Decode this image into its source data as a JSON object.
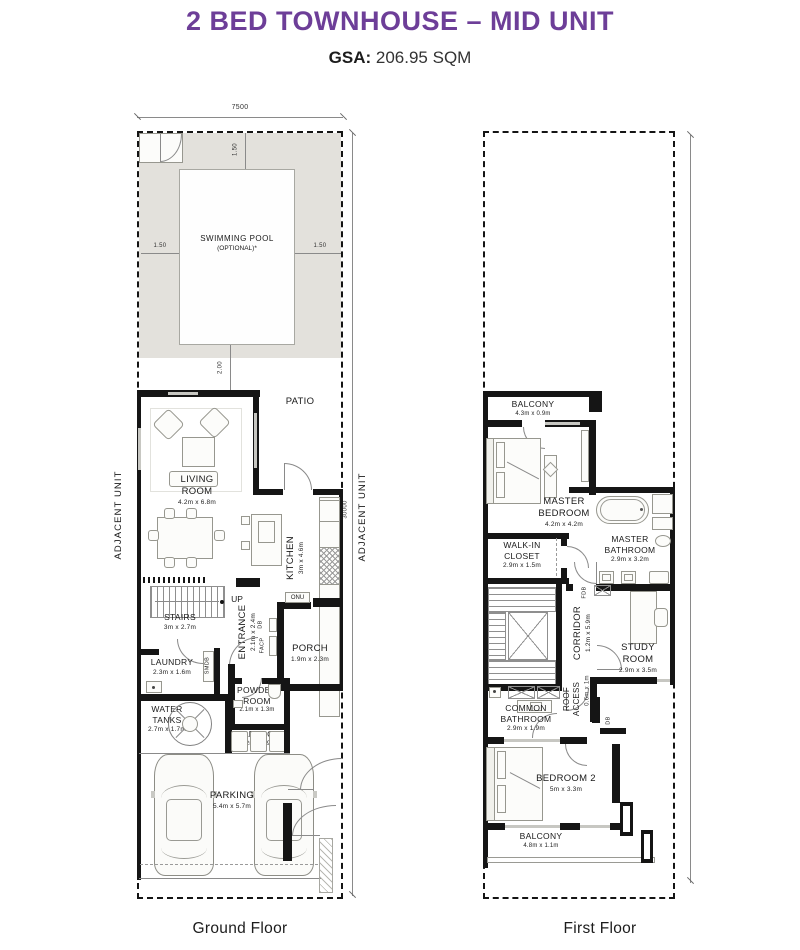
{
  "colors": {
    "accent": "#6D3E98",
    "wall": "#151515",
    "deck": "#E3E1DC"
  },
  "header": {
    "title": "2 BED TOWNHOUSE – MID UNIT",
    "gsa_label": "GSA:",
    "gsa_value": "206.95 SQM"
  },
  "ground_floor": {
    "caption": "Ground Floor",
    "dim_width": "7500",
    "dim_height": "30000",
    "adjacent_left": "ADJACENT UNIT",
    "adjacent_right": "ADJACENT UNIT",
    "pool": {
      "name": "SWIMMING POOL",
      "note": "(OPTIONAL)*",
      "dim_top": "1.50",
      "dim_left": "1.50",
      "dim_right": "1.50",
      "dim_bottom": "2.00"
    },
    "patio": {
      "name": "PATIO"
    },
    "living_room": {
      "name": "LIVING ROOM",
      "dims": "4.2m x 6.8m"
    },
    "kitchen": {
      "name": "KITCHEN",
      "dims": "3m x 4.6m"
    },
    "stairs": {
      "name": "STAIRS",
      "dims": "3m x 2.7m",
      "up": "UP"
    },
    "entrance": {
      "name": "ENTRANCE",
      "dims": "2.1m x 2.4m"
    },
    "porch": {
      "name": "PORCH",
      "dims": "1.9m x 2.3m"
    },
    "laundry": {
      "name": "LAUNDRY",
      "dims": "2.3m x 1.6m"
    },
    "powder_room": {
      "name": "POWDER ROOM",
      "dims": "2.1m x 1.3m"
    },
    "water_tanks": {
      "name": "WATER TANKS",
      "dims": "2.7m x 1.7m"
    },
    "garbage": {
      "name": "GARBAGE",
      "dims": "2.2m x 0.9m"
    },
    "parking": {
      "name": "PARKING",
      "dims": "5.4m x 5.7m"
    },
    "equipment": {
      "onu": "ONU",
      "db": "DB",
      "facp": "FACP",
      "smdb": "SMDB"
    }
  },
  "first_floor": {
    "caption": "First Floor",
    "balcony_top": {
      "name": "BALCONY",
      "dims": "4.3m x 0.9m"
    },
    "master_bedroom": {
      "name": "MASTER BEDROOM",
      "dims": "4.2m x 4.2m"
    },
    "walk_in_closet": {
      "name": "WALK-IN CLOSET",
      "dims": "2.9m x 1.5m"
    },
    "master_bathroom": {
      "name": "MASTER BATHROOM",
      "dims": "2.9m x 3.2m"
    },
    "corridor": {
      "name": "CORRIDOR",
      "dims": "1.2m x 5.9m"
    },
    "study_room": {
      "name": "STUDY ROOM",
      "dims": "2.9m x 3.5m"
    },
    "roof_access": {
      "name": "ROOF ACCESS",
      "dims": "0.6m x 1m"
    },
    "common_bathroom": {
      "name": "COMMON BATHROOM",
      "dims": "2.9m x 1.9m"
    },
    "bedroom_2": {
      "name": "BEDROOM 2",
      "dims": "5m x 3.3m"
    },
    "balcony_bottom": {
      "name": "BALCONY",
      "dims": "4.8m x 1.1m"
    },
    "equipment": {
      "fdb": "FDB",
      "db": "DB"
    }
  }
}
